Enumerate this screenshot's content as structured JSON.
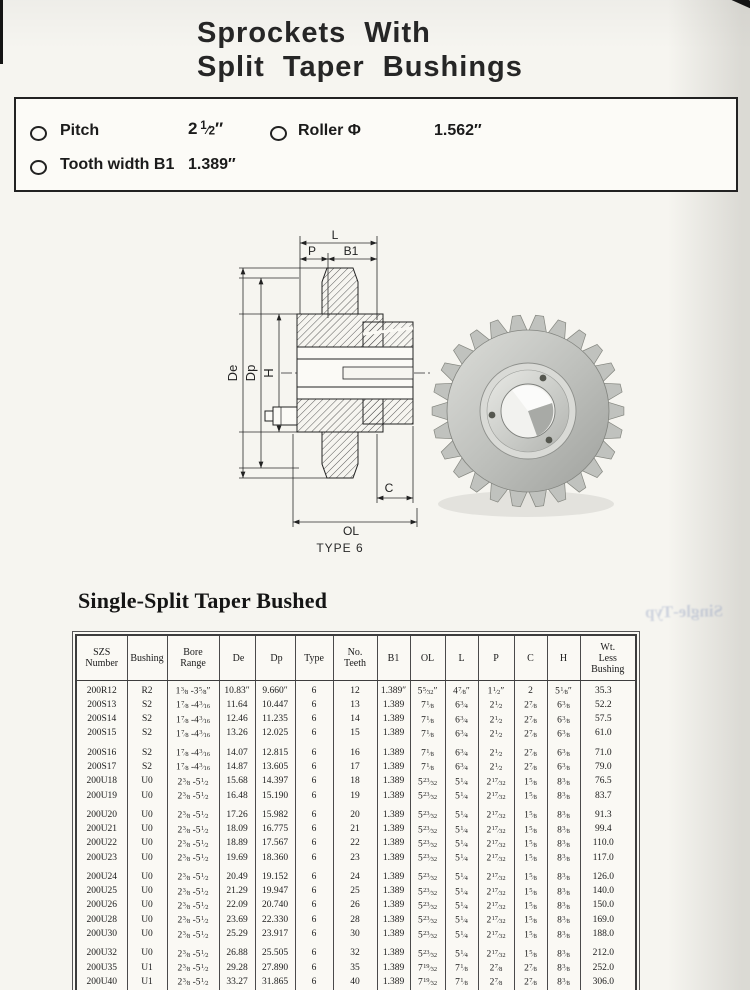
{
  "title": {
    "line1": "Sprockets With",
    "line2": "Split Taper Bushings"
  },
  "specs": {
    "pitch_label": "Pitch",
    "pitch_value": "2 1/2″",
    "roller_label": "Roller Φ",
    "roller_value": "1.562″",
    "tooth_width_label": "Tooth width B1",
    "tooth_width_value": "1.389″"
  },
  "diagram": {
    "caption": "TYPE 6",
    "labels": {
      "l": "L",
      "p": "P",
      "b1": "B1",
      "de": "De",
      "dp": "Dp",
      "h": "H",
      "c": "C",
      "ol": "OL"
    }
  },
  "section": {
    "heading": "Single-Split Taper Bushed"
  },
  "artifacts": {
    "ghost_text": "Single-Typ"
  },
  "table": {
    "columns": [
      "SZS\nNumber",
      "Bushing",
      "Bore\nRange",
      "De",
      "Dp",
      "Type",
      "No.\nTeeth",
      "B1",
      "OL",
      "L",
      "P",
      "C",
      "H",
      "Wt.\nLess\nBushing"
    ],
    "groups": [
      [
        [
          "200R12",
          "R2",
          "1 3/8 -3 5/8″",
          "10.83″",
          "9.660″",
          "6",
          "12",
          "1.389″",
          "5 5/32″",
          "4 7/8″",
          "1 1/2″",
          "2",
          "5 1/8″",
          "35.3"
        ],
        [
          "200S13",
          "S2",
          "1 7/8 -4 3/16",
          "11.64",
          "10.447",
          "6",
          "13",
          "1.389",
          "7 1/8",
          "6 3/4",
          "2 1/2",
          "2 7/8",
          "6 3/8",
          "52.2"
        ],
        [
          "200S14",
          "S2",
          "1 7/8 -4 3/16",
          "12.46",
          "11.235",
          "6",
          "14",
          "1.389",
          "7 1/8",
          "6 3/4",
          "2 1/2",
          "2 7/8",
          "6 3/8",
          "57.5"
        ],
        [
          "200S15",
          "S2",
          "1 7/8 -4 3/16",
          "13.26",
          "12.025",
          "6",
          "15",
          "1.389",
          "7 1/8",
          "6 3/4",
          "2 1/2",
          "2 7/8",
          "6 3/8",
          "61.0"
        ]
      ],
      [
        [
          "200S16",
          "S2",
          "1 7/8 -4 3/16",
          "14.07",
          "12.815",
          "6",
          "16",
          "1.389",
          "7 1/8",
          "6 3/4",
          "2 1/2",
          "2 7/8",
          "6 3/8",
          "71.0"
        ],
        [
          "200S17",
          "S2",
          "1 7/8 -4 3/16",
          "14.87",
          "13.605",
          "6",
          "17",
          "1.389",
          "7 1/8",
          "6 3/4",
          "2 1/2",
          "2 7/8",
          "6 3/8",
          "79.0"
        ],
        [
          "200U18",
          "U0",
          "2 3/8 -5 1/2",
          "15.68",
          "14.397",
          "6",
          "18",
          "1.389",
          "5 23/32",
          "5 1/4",
          "2 17/32",
          "1 5/8",
          "8 3/8",
          "76.5"
        ],
        [
          "200U19",
          "U0",
          "2 3/8 -5 1/2",
          "16.48",
          "15.190",
          "6",
          "19",
          "1.389",
          "5 23/32",
          "5 1/4",
          "2 17/32",
          "1 5/8",
          "8 3/8",
          "83.7"
        ]
      ],
      [
        [
          "200U20",
          "U0",
          "2 3/8 -5 1/2",
          "17.26",
          "15.982",
          "6",
          "20",
          "1.389",
          "5 23/32",
          "5 1/4",
          "2 17/32",
          "1 5/8",
          "8 3/8",
          "91.3"
        ],
        [
          "200U21",
          "U0",
          "2 3/8 -5 1/2",
          "18.09",
          "16.775",
          "6",
          "21",
          "1.389",
          "5 23/32",
          "5 1/4",
          "2 17/32",
          "1 5/8",
          "8 3/8",
          "99.4"
        ],
        [
          "200U22",
          "U0",
          "2 3/8 -5 1/2",
          "18.89",
          "17.567",
          "6",
          "22",
          "1.389",
          "5 23/32",
          "5 1/4",
          "2 17/32",
          "1 5/8",
          "8 3/8",
          "110.0"
        ],
        [
          "200U23",
          "U0",
          "2 3/8 -5 1/2",
          "19.69",
          "18.360",
          "6",
          "23",
          "1.389",
          "5 23/32",
          "5 1/4",
          "2 17/32",
          "1 5/8",
          "8 3/8",
          "117.0"
        ]
      ],
      [
        [
          "200U24",
          "U0",
          "2 3/8 -5 1/2",
          "20.49",
          "19.152",
          "6",
          "24",
          "1.389",
          "5 23/32",
          "5 1/4",
          "2 17/32",
          "1 5/8",
          "8 3/8",
          "126.0"
        ],
        [
          "200U25",
          "U0",
          "2 3/8 -5 1/2",
          "21.29",
          "19.947",
          "6",
          "25",
          "1.389",
          "5 23/32",
          "5 1/4",
          "2 17/32",
          "1 5/8",
          "8 3/8",
          "140.0"
        ],
        [
          "200U26",
          "U0",
          "2 3/8 -5 1/2",
          "22.09",
          "20.740",
          "6",
          "26",
          "1.389",
          "5 23/32",
          "5 1/4",
          "2 17/32",
          "1 5/8",
          "8 3/8",
          "150.0"
        ],
        [
          "200U28",
          "U0",
          "2 3/8 -5 1/2",
          "23.69",
          "22.330",
          "6",
          "28",
          "1.389",
          "5 23/32",
          "5 1/4",
          "2 17/32",
          "1 5/8",
          "8 3/8",
          "169.0"
        ],
        [
          "200U30",
          "U0",
          "2 3/8 -5 1/2",
          "25.29",
          "23.917",
          "6",
          "30",
          "1.389",
          "5 23/32",
          "5 1/4",
          "2 17/32",
          "1 5/8",
          "8 3/8",
          "188.0"
        ]
      ],
      [
        [
          "200U32",
          "U0",
          "2 3/8 -5 1/2",
          "26.88",
          "25.505",
          "6",
          "32",
          "1.389",
          "5 23/32",
          "5 1/4",
          "2 17/32",
          "1 5/8",
          "8 3/8",
          "212.0"
        ],
        [
          "200U35",
          "U1",
          "2 3/8 -5 1/2",
          "29.28",
          "27.890",
          "6",
          "35",
          "1.389",
          "7 19/32",
          "7 1/8",
          "2 7/8",
          "2 7/8",
          "8 3/8",
          "252.0"
        ],
        [
          "200U40",
          "U1",
          "2 3/8 -5 1/2",
          "33.27",
          "31.865",
          "6",
          "40",
          "1.389",
          "7 19/32",
          "7 1/8",
          "2 7/8",
          "2 7/8",
          "8 3/8",
          "306.0"
        ],
        [
          "200U45",
          "U1",
          "2 3/8 -5 1/2",
          "37.25",
          "35.840",
          "6",
          "45",
          "1.389",
          "7 19/32",
          "7 1/8",
          "2 7/8",
          "2 7/8",
          "8 3/8",
          "290.0"
        ],
        [
          "200U54",
          "U2",
          "2 7/16 -5",
          "44.42",
          "42.995",
          "6",
          "54",
          "1.389",
          "10 19/32",
          "10 1/8",
          "3 29/32",
          "4 1/4",
          "8 3/8",
          "385.0"
        ],
        [
          "200U60",
          "U2",
          "2 7/16 -5",
          "49.20",
          "47.767",
          "6",
          "60",
          "1.389",
          "10 19/32",
          "10 1/8",
          "3 29/32",
          "4 1/4",
          "8 3/8",
          "445.0"
        ]
      ]
    ]
  }
}
